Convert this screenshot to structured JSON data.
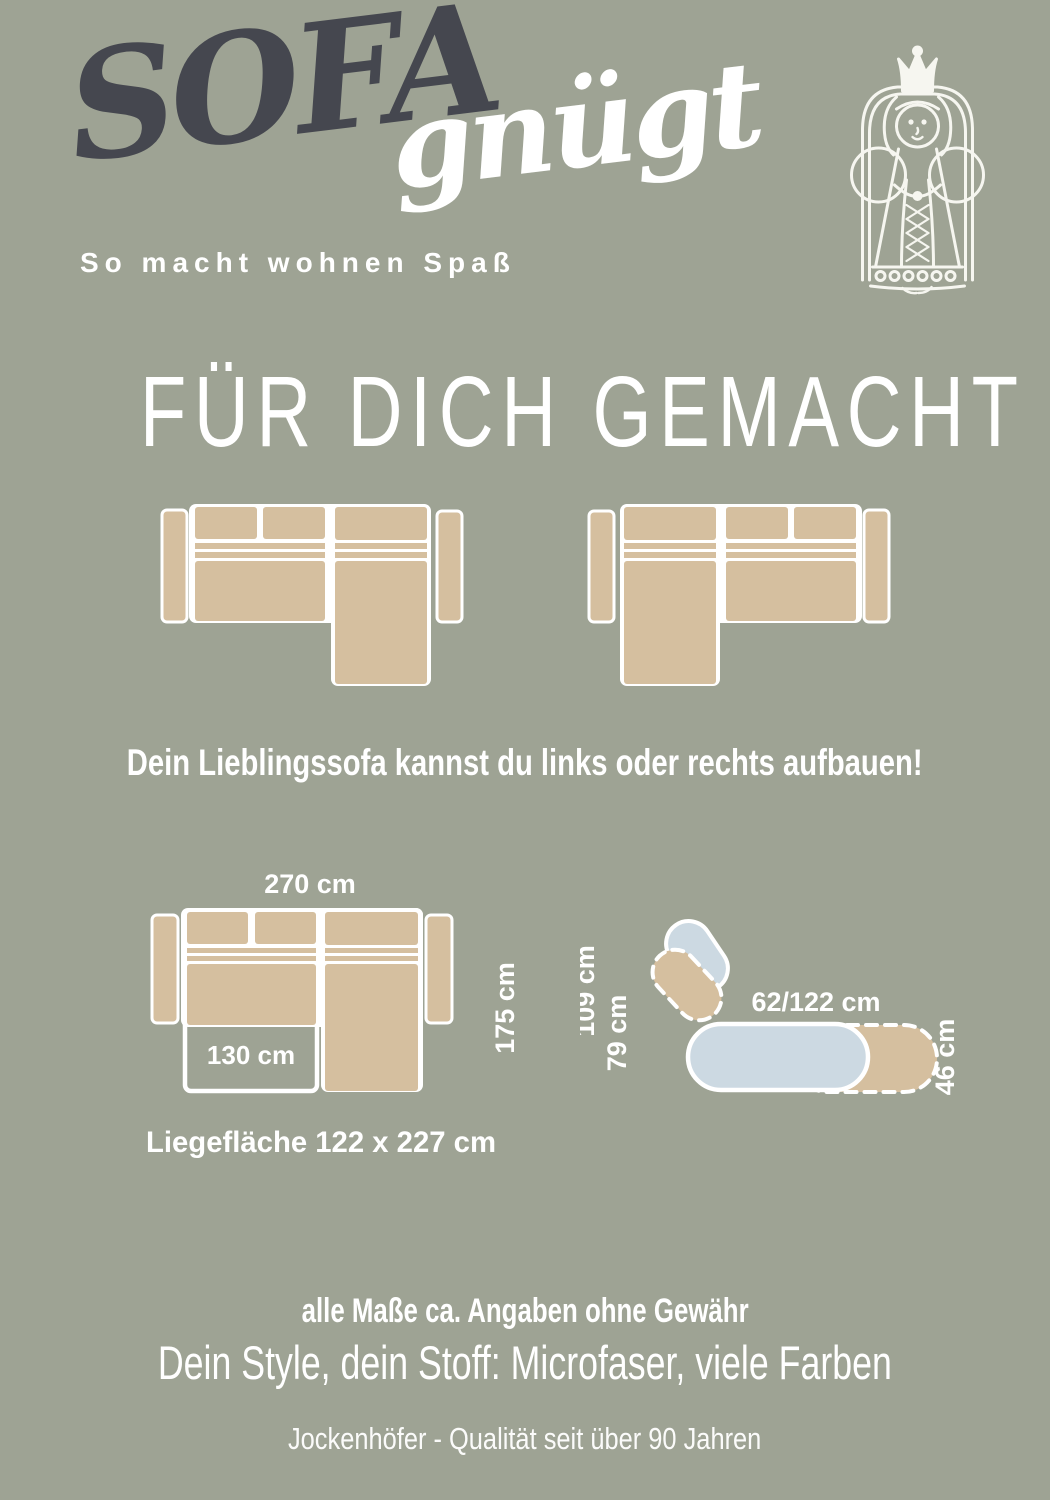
{
  "colors": {
    "background": "#9EA394",
    "sofa_beige": "#D5BF9F",
    "function_blue": "#CCD9E2",
    "logo_dark": "#45474F",
    "text_white": "#FFFFFF"
  },
  "header": {
    "logo_sofa": "SOFA",
    "logo_suffix": "gnügt",
    "tagline": "So macht wohnen Spaß",
    "mascot_icon": "queen-on-throne"
  },
  "headline": {
    "text": "FÜR DICH GEMACHT"
  },
  "variants": {
    "note": "Dein Lieblingssofa kannst du links oder rechts aufbauen!",
    "left_diagram": "sofa-top-view-chaise-right",
    "right_diagram": "sofa-top-view-chaise-left"
  },
  "dimension_diagram": {
    "total_width": "270 cm",
    "total_depth": "175 cm",
    "bed_extension_width": "130 cm",
    "sleeping_surface": "Liegefläche 122 x 227 cm"
  },
  "function_diagram": {
    "backrest_measure": "109 cm",
    "backrest_reclined_measure": "79 cm",
    "seat_depth_range": "62/122 cm",
    "seat_height": "46 cm"
  },
  "footer": {
    "disclaimer": "alle Maße ca. Angaben ohne Gewähr",
    "fabric_line": "Dein Style, dein Stoff: Microfaser, viele Farben",
    "brand_line": "Jockenhöfer - Qualität seit über 90 Jahren"
  }
}
